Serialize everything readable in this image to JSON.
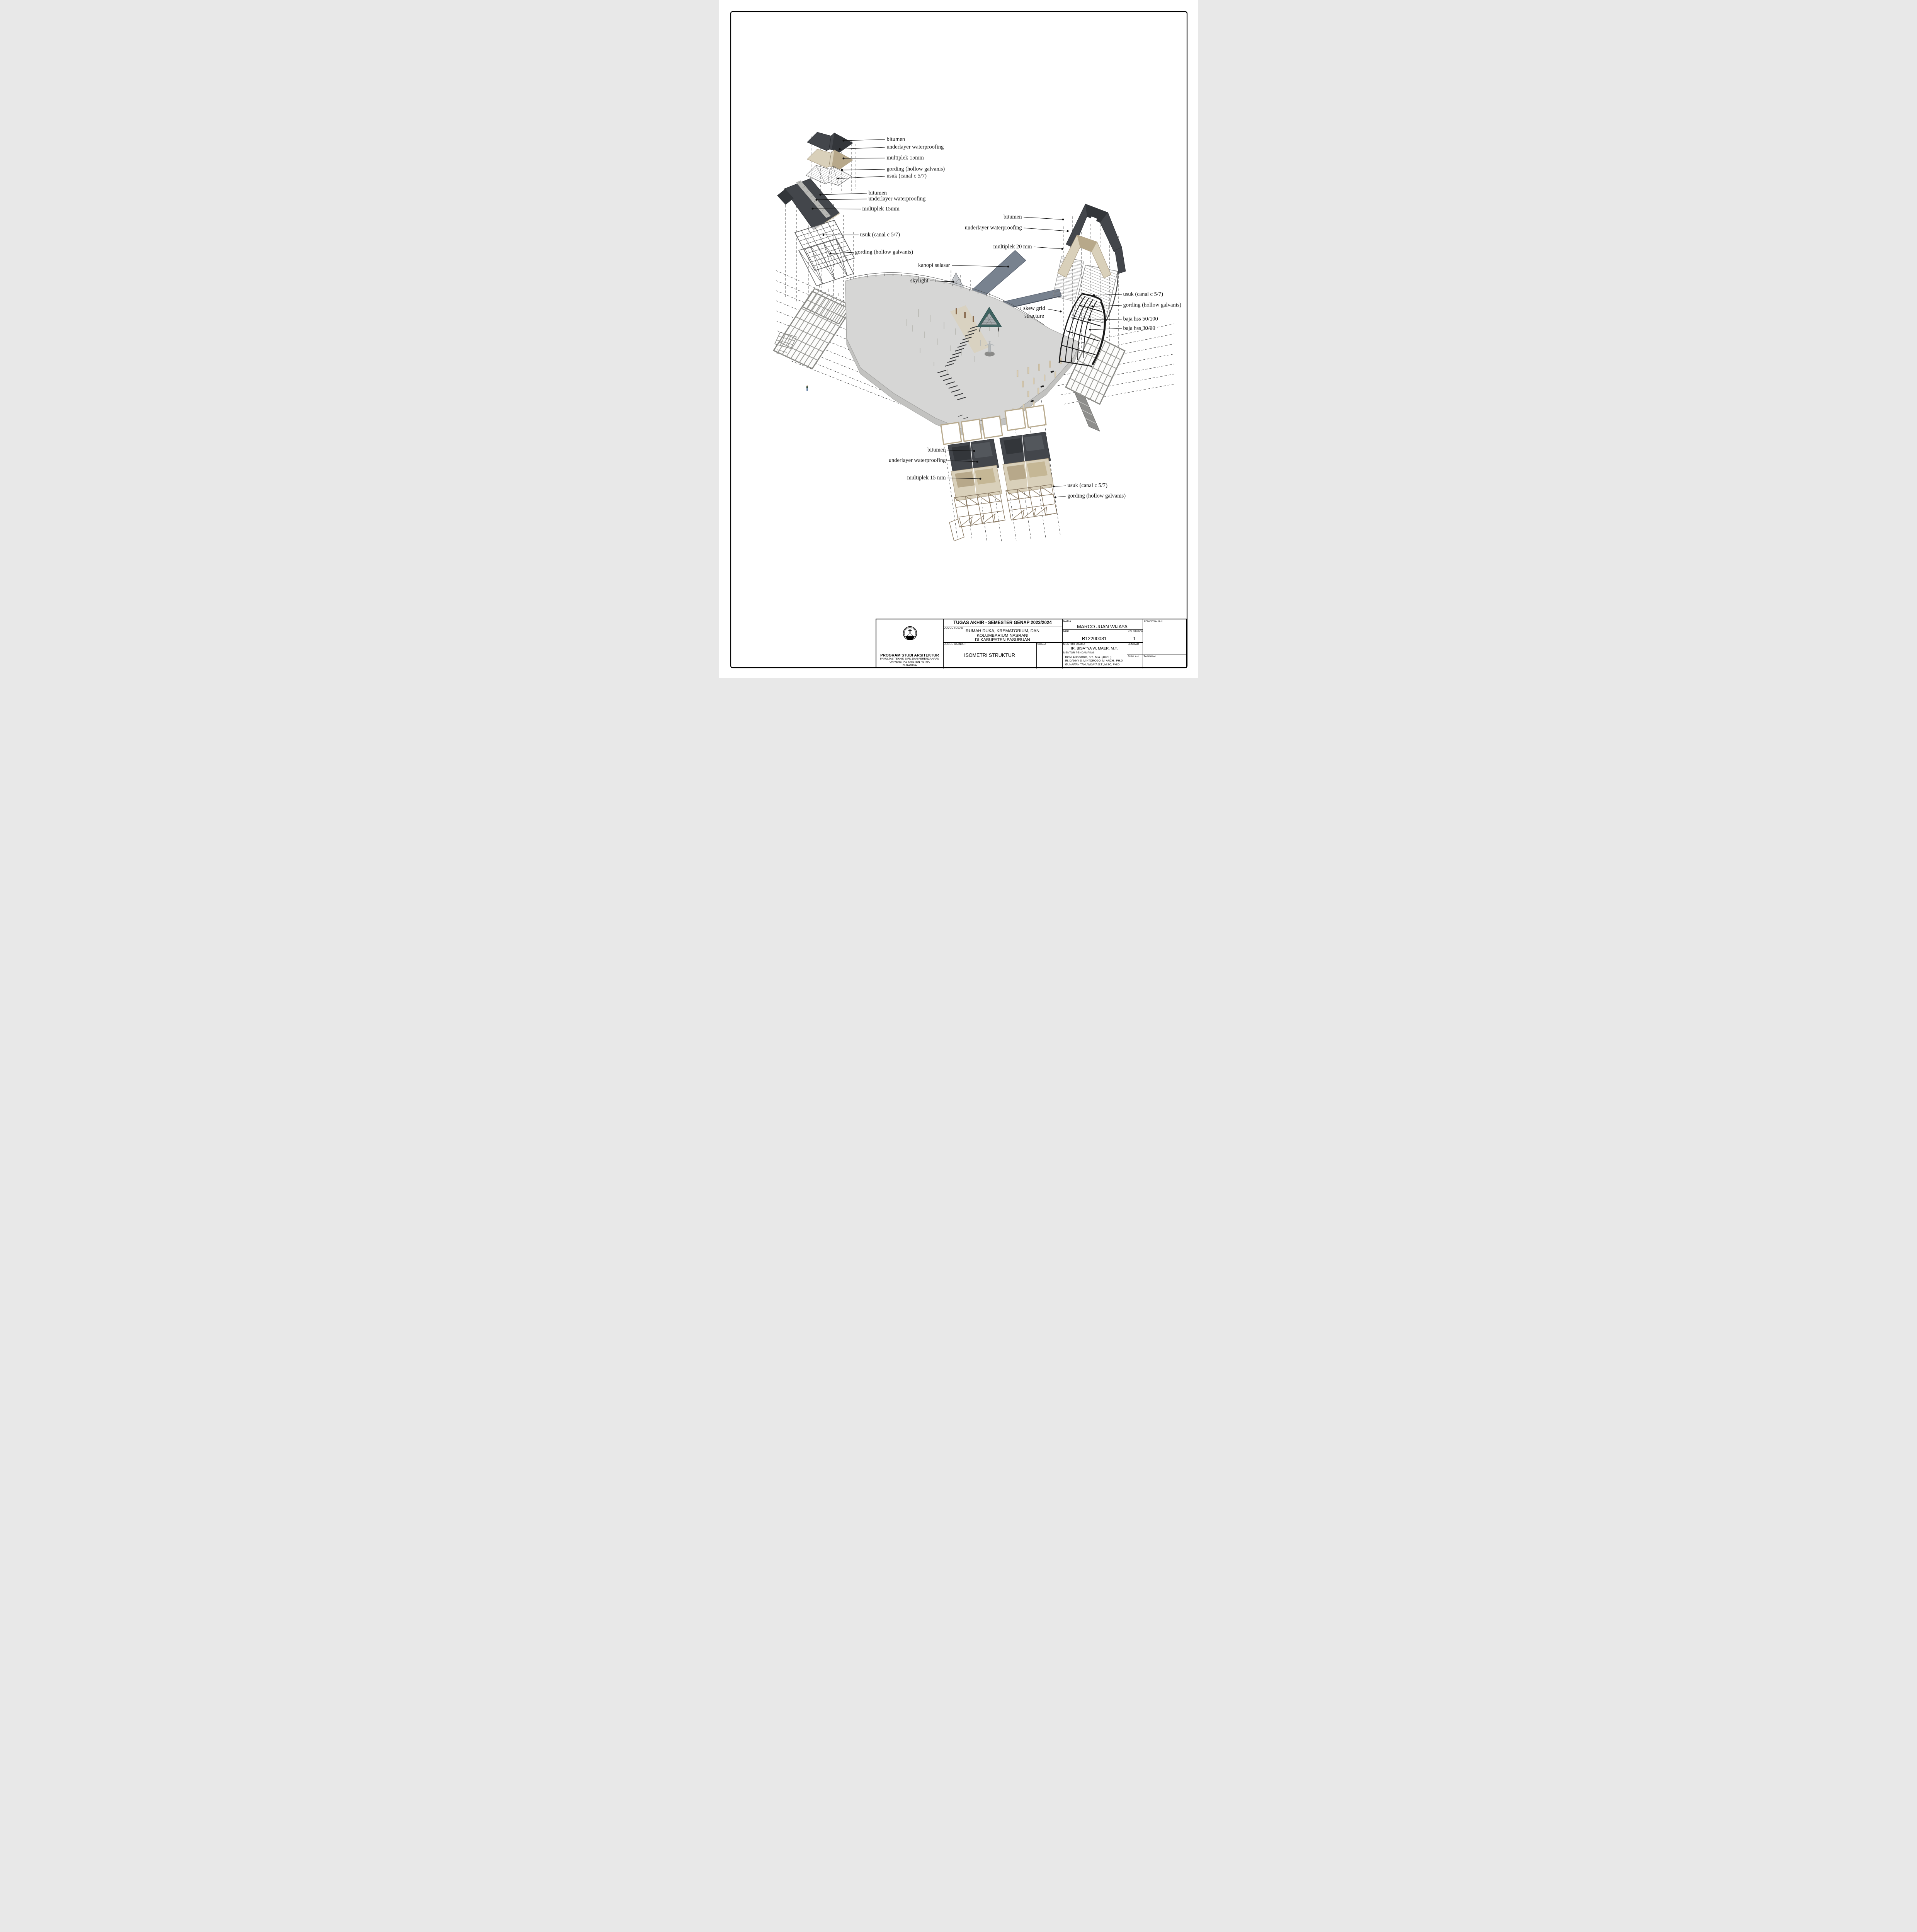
{
  "diagram": {
    "top_left": {
      "bitumen": "bitumen",
      "underlayer": "underlayer waterproofing",
      "multiplek": "multiplek 15mm",
      "gording": "gording (hollow galvanis)",
      "usuk": "usuk (canal c 5/7)"
    },
    "mid_left": {
      "bitumen": "bitumen",
      "underlayer": "underlayer waterproofing",
      "multiplek": "multiplek 15mm",
      "usuk": "usuk (canal c 5/7)",
      "gording": "gording (hollow galvanis)"
    },
    "right_roof": {
      "bitumen": "bitumen",
      "underlayer": "underlayer waterproofing",
      "multiplek": "multiplek 20 mm"
    },
    "right_structure": {
      "usuk": "usuk (canal c 5/7)",
      "gording": "gording (hollow galvanis)",
      "skew_line1": "skew grid",
      "skew_line2": "structure",
      "baja1": "baja hss 50/100",
      "baja2": "baja hss 30/60"
    },
    "center": {
      "kanopi": "kanopi selasar",
      "skylight": "skylight"
    },
    "bottom": {
      "bitumen": "bitumen",
      "underlayer": "underlayer waterproofing",
      "multiplek": "multiplek 15 mm",
      "usuk": "usuk (canal c 5/7)",
      "gording": "gording (hollow galvanis)"
    }
  },
  "title_block": {
    "header": "TUGAS AKHIR - SEMESTER GENAP 2023/2024",
    "judul_tugas_label": "JUDUL TUGAS",
    "judul_tugas_lines": [
      "RUMAH DUKA, KREMATORIUM, DAN",
      "KOLUMBARIUM NASRANI",
      "DI KABUPATEN PASURUAN"
    ],
    "judul_gambar_label": "JUDUL GAMBAR",
    "judul_gambar": "ISOMETRI STRUKTUR",
    "skala_label": "SKALA",
    "nama_label": "NAMA",
    "nama": "MARCO JUAN WIJAYA",
    "nrp_label": "NRP",
    "nrp": "B12200081",
    "kelompok_label": "KELOMPOK",
    "kelompok": "1",
    "mentor_utama_label": "MENTOR UTAMA",
    "mentor_utama": "IR. BISATYA W. MAER, M.T.",
    "mentor_pendamping_label": "MENTOR PENDAMPING",
    "mentor_pendamping": [
      "RONI ANGGORO, S.T., M.A. (ARCH)",
      "IR. DANNY S. MINTOROGO, M. ARCH., PH.D",
      "GUNAWAN TANUWIJAYA S.T., M.SC, PH.D."
    ],
    "lembar_label": "LEMBAR",
    "jumlah_label": "JUMLAH",
    "pengesahan_label": "PENGESAHAN",
    "tanggal_label": "TANGGAL",
    "institution": {
      "program": "PROGRAM STUDI ARSITEKTUR",
      "faculty": "FAKULTAS TEKNIK SIPIL DAN PERENCANAAN",
      "university": "UNIVERSITAS KRISTEN PETRA",
      "city": "SURABAYA",
      "logo_arc_top": "UNIVERSITAS KRISTEN",
      "logo_arc_bottom": "PETRA"
    }
  },
  "colors": {
    "bitumen": "#43464b",
    "bitumen_dark": "#33363a",
    "multiplek": "#d9d0ba",
    "multiplek_dark": "#b7a88a",
    "kanopi": "#78828f",
    "teal": "#3e6361",
    "steel_black": "#1b1b1b",
    "gording_brown": "#8a7a64",
    "slab": "#d6d6d5",
    "slab_side": "#c2c2c0",
    "grid_line": "#9a9a96",
    "ink": "#111111"
  }
}
